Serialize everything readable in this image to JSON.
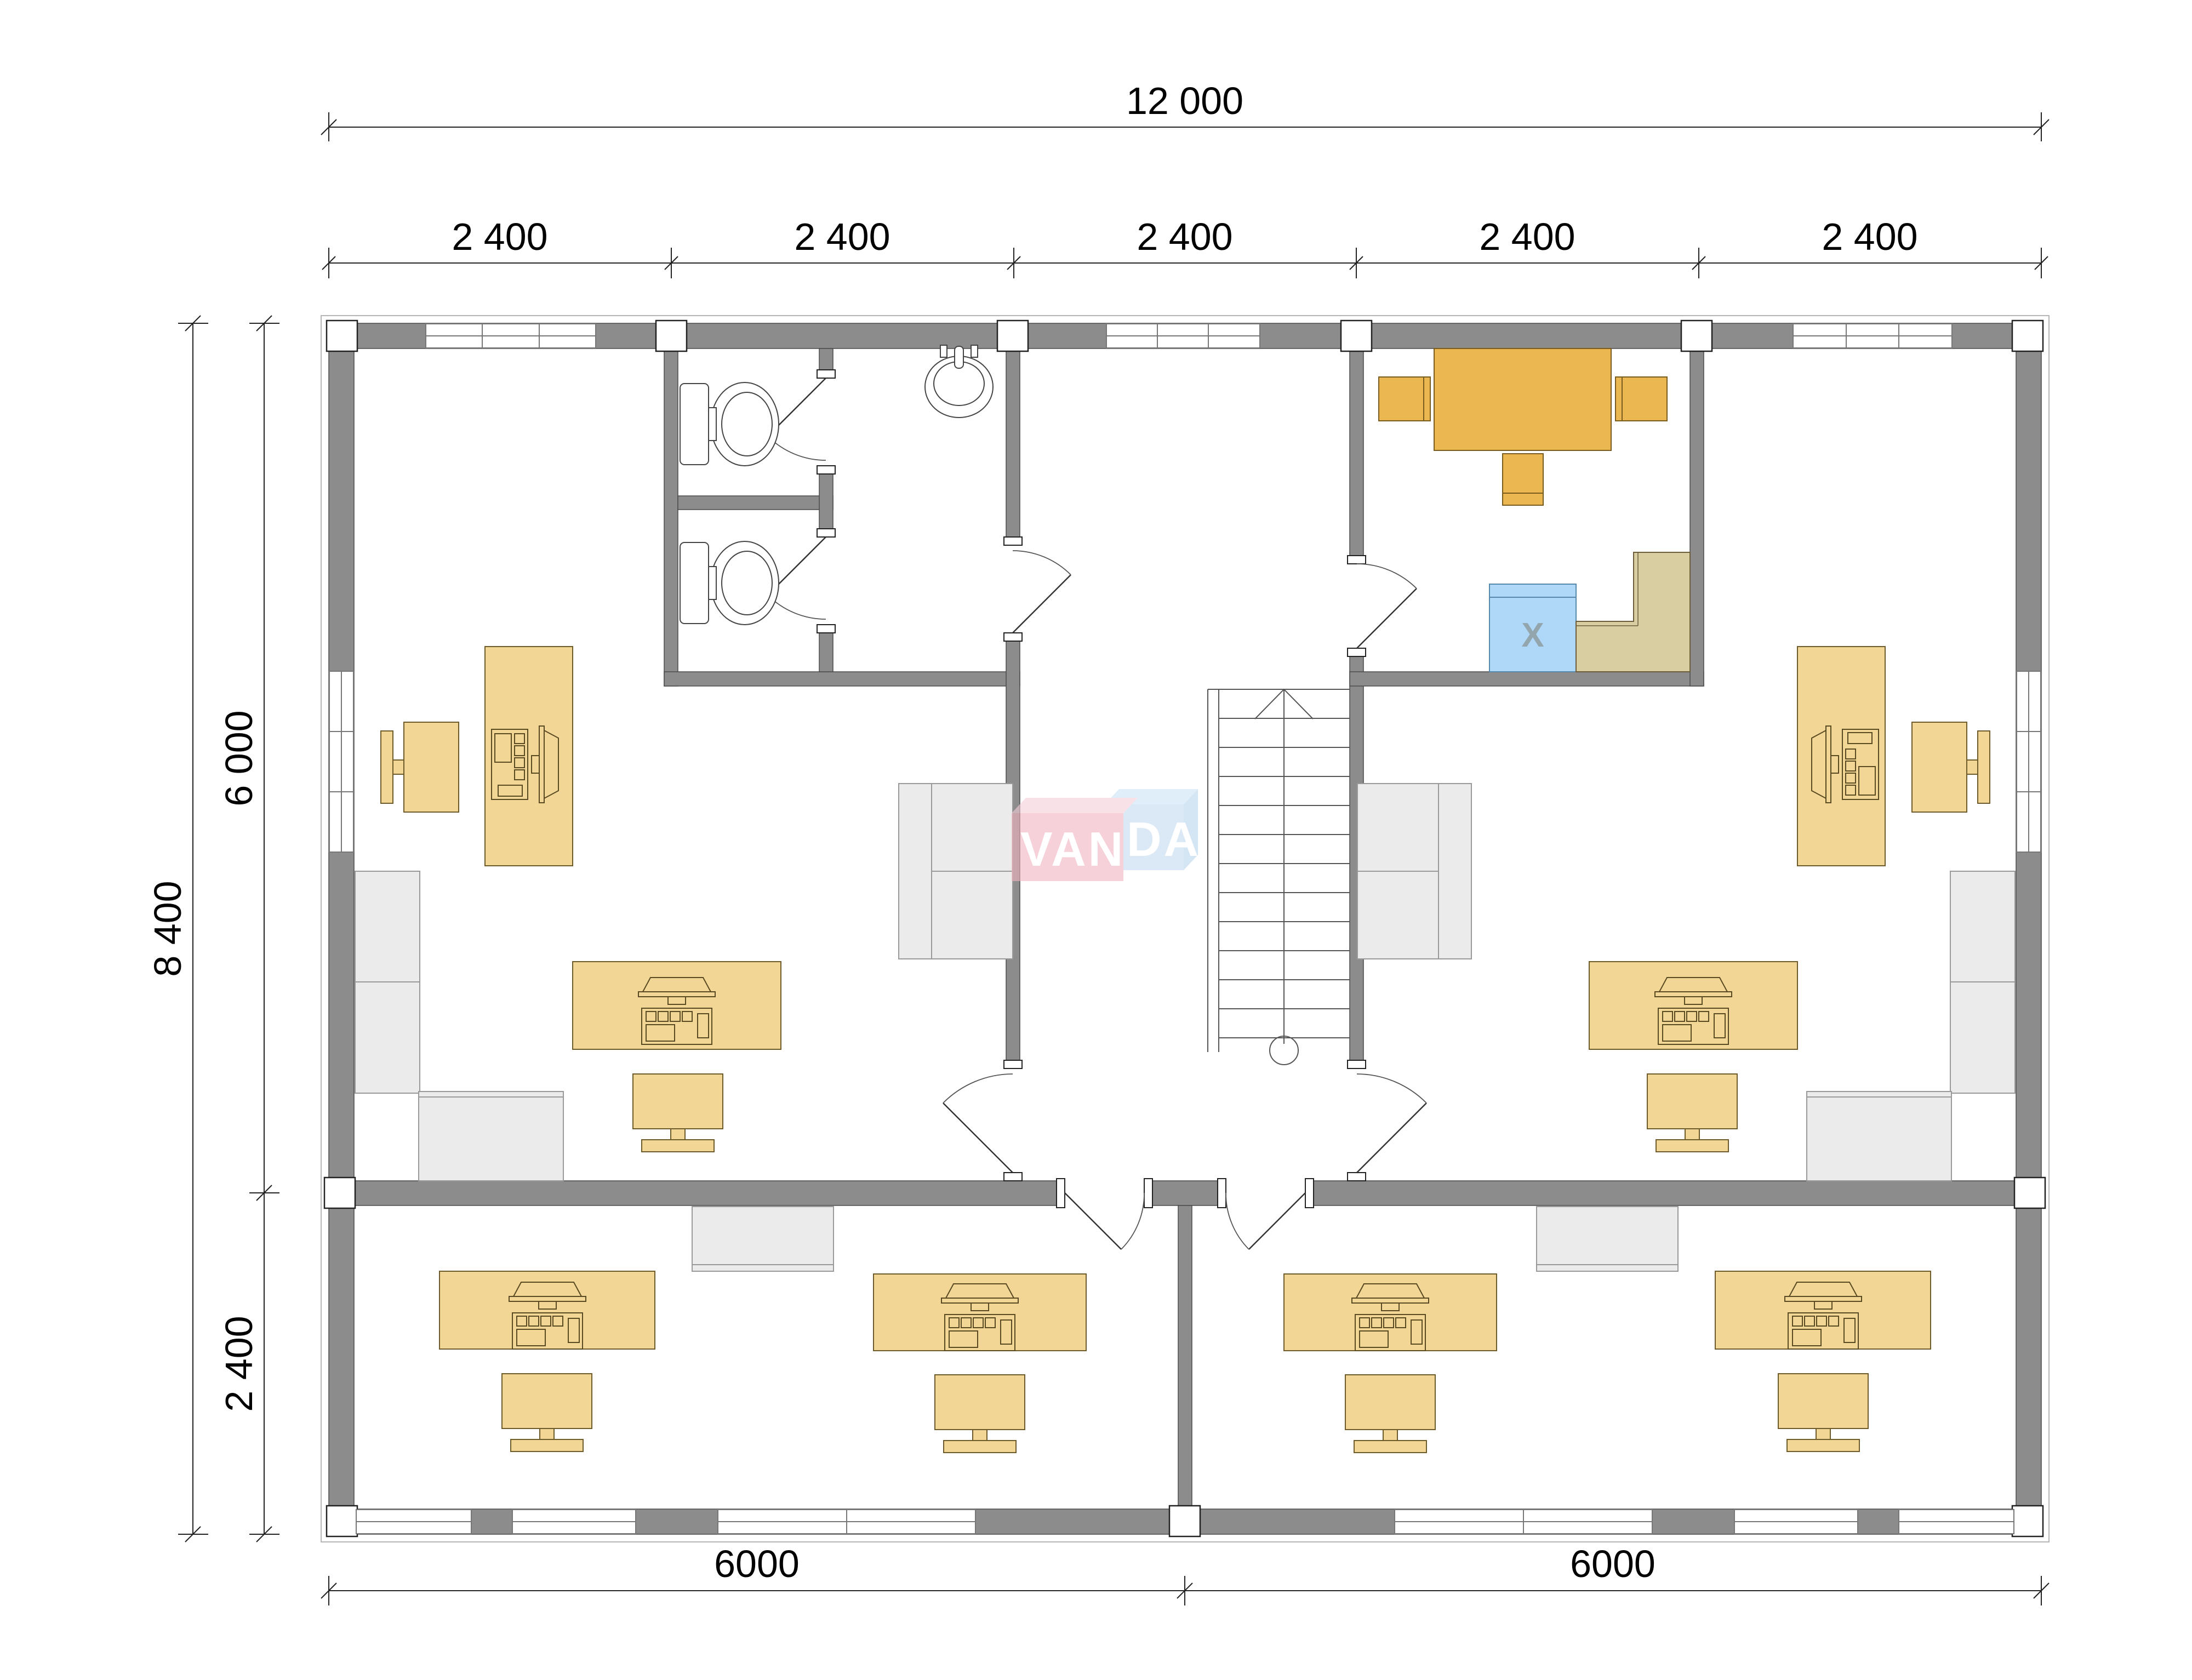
{
  "drawing": {
    "type": "architectural-floor-plan",
    "dimensions": {
      "top_overall": "12 000",
      "bays": [
        "2 400",
        "2 400",
        "2 400",
        "2 400",
        "2 400"
      ],
      "left_overall": "8 400",
      "left_upper": "6 000",
      "left_lower": "2 400",
      "bottom_left": "6000",
      "bottom_right": "6000"
    },
    "marks": {
      "appliance_x": "X"
    },
    "watermark": {
      "full": "VANDA",
      "part1": "VAN",
      "part2": "DA"
    },
    "colors": {
      "wall": "#8c8c8c",
      "desk_tan": "#f2d695",
      "meeting_amber": "#ebb751",
      "appliance_blue": "#aed7f8",
      "counter_khaki": "#d9cda2",
      "gray_furniture": "#ebebeb",
      "logo_pink": "#f2b4c0",
      "logo_blue": "#c4dcf2"
    }
  }
}
